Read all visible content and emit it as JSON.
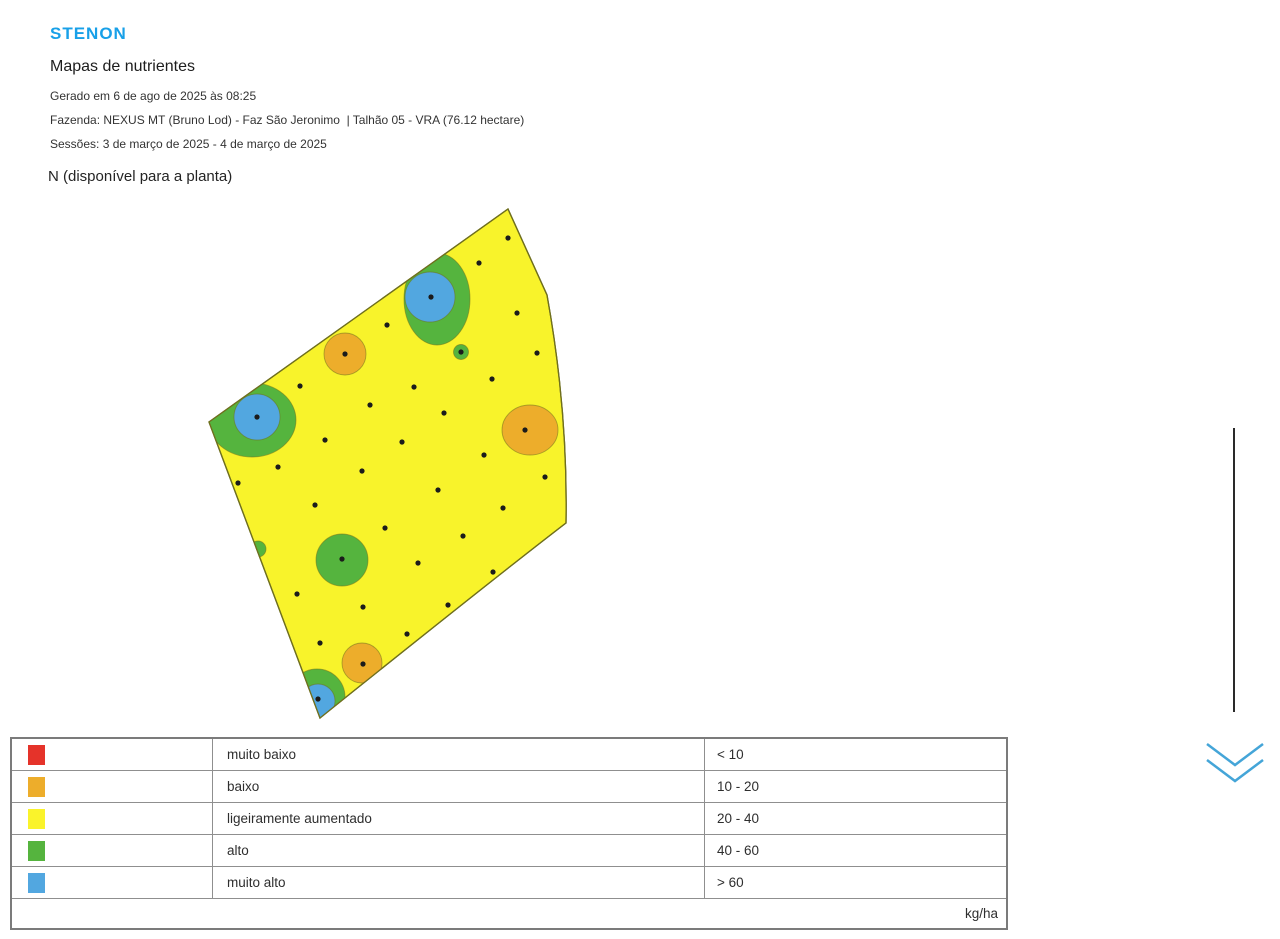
{
  "brand": {
    "logo_text": "STENON",
    "logo_color": "#18A0E8"
  },
  "header": {
    "title": "Mapas de nutrientes",
    "generated_line": "Gerado em 6 de ago de 2025 às 08:25",
    "farm_line": "Fazenda: NEXUS MT (Bruno Lod) - Faz São Jeronimo  | Talhão 05 - VRA (76.12 hectare)",
    "sessions_line": "Sessões: 3 de março de 2025 - 4 de março de 2025"
  },
  "map": {
    "title": "N (disponível para a planta)",
    "colors": {
      "yellow": "#F8F32B",
      "green": "#55B43E",
      "blue": "#52A7E0",
      "orange": "#EDAD2B",
      "outline": "#6F6F1E",
      "dot": "#1b1b1b"
    },
    "field_path": "M 508 209 L 547 295 Q 568 411 566 523 Q 497 576 320 718 L 209 422 Z",
    "blobs": [
      {
        "shape": "ellipse",
        "cx": 437,
        "cy": 299,
        "rx": 33,
        "ry": 46,
        "color": "green"
      },
      {
        "shape": "circle",
        "cx": 430,
        "cy": 297,
        "r": 25,
        "color": "blue"
      },
      {
        "shape": "circle",
        "cx": 345,
        "cy": 354,
        "r": 21,
        "color": "orange"
      },
      {
        "shape": "circle",
        "cx": 461,
        "cy": 352,
        "r": 7.5,
        "color": "green"
      },
      {
        "shape": "ellipse",
        "cx": 252,
        "cy": 420,
        "rx": 44,
        "ry": 37,
        "color": "green"
      },
      {
        "shape": "circle",
        "cx": 257,
        "cy": 417,
        "r": 23,
        "color": "blue"
      },
      {
        "shape": "ellipse",
        "cx": 530,
        "cy": 430,
        "rx": 28,
        "ry": 25,
        "color": "orange"
      },
      {
        "shape": "circle",
        "cx": 342,
        "cy": 560,
        "r": 26,
        "color": "green"
      },
      {
        "shape": "circle",
        "cx": 258,
        "cy": 549,
        "r": 8,
        "color": "green"
      },
      {
        "shape": "circle",
        "cx": 362,
        "cy": 663,
        "r": 20,
        "color": "orange"
      },
      {
        "shape": "circle",
        "cx": 317,
        "cy": 697,
        "r": 28,
        "color": "green"
      },
      {
        "shape": "circle",
        "cx": 318,
        "cy": 701,
        "r": 17,
        "color": "blue"
      }
    ],
    "dots": [
      [
        508,
        238
      ],
      [
        479,
        263
      ],
      [
        431,
        297
      ],
      [
        517,
        313
      ],
      [
        387,
        325
      ],
      [
        345,
        354
      ],
      [
        461,
        352
      ],
      [
        537,
        353
      ],
      [
        492,
        379
      ],
      [
        300,
        386
      ],
      [
        414,
        387
      ],
      [
        370,
        405
      ],
      [
        444,
        413
      ],
      [
        257,
        417
      ],
      [
        525,
        430
      ],
      [
        325,
        440
      ],
      [
        402,
        442
      ],
      [
        484,
        455
      ],
      [
        278,
        467
      ],
      [
        362,
        471
      ],
      [
        545,
        477
      ],
      [
        238,
        483
      ],
      [
        438,
        490
      ],
      [
        315,
        505
      ],
      [
        503,
        508
      ],
      [
        385,
        528
      ],
      [
        463,
        536
      ],
      [
        537,
        548
      ],
      [
        342,
        559
      ],
      [
        418,
        563
      ],
      [
        493,
        572
      ],
      [
        297,
        594
      ],
      [
        363,
        607
      ],
      [
        448,
        605
      ],
      [
        407,
        634
      ],
      [
        320,
        643
      ],
      [
        363,
        664
      ],
      [
        318,
        699
      ]
    ]
  },
  "legend": {
    "rows": [
      {
        "color": "#E5332A",
        "label": "muito baixo",
        "range": "< 10"
      },
      {
        "color": "#EDAD2B",
        "label": "baixo",
        "range": "10 - 20"
      },
      {
        "color": "#FAF32B",
        "label": "ligeiramente aumentado",
        "range": "20 - 40"
      },
      {
        "color": "#55B43E",
        "label": "alto",
        "range": "40 - 60"
      },
      {
        "color": "#52A7E0",
        "label": "muito alto",
        "range": "> 60"
      }
    ],
    "unit": "kg/ha"
  },
  "scroll": {
    "indicator_color": "#44A5D8"
  }
}
